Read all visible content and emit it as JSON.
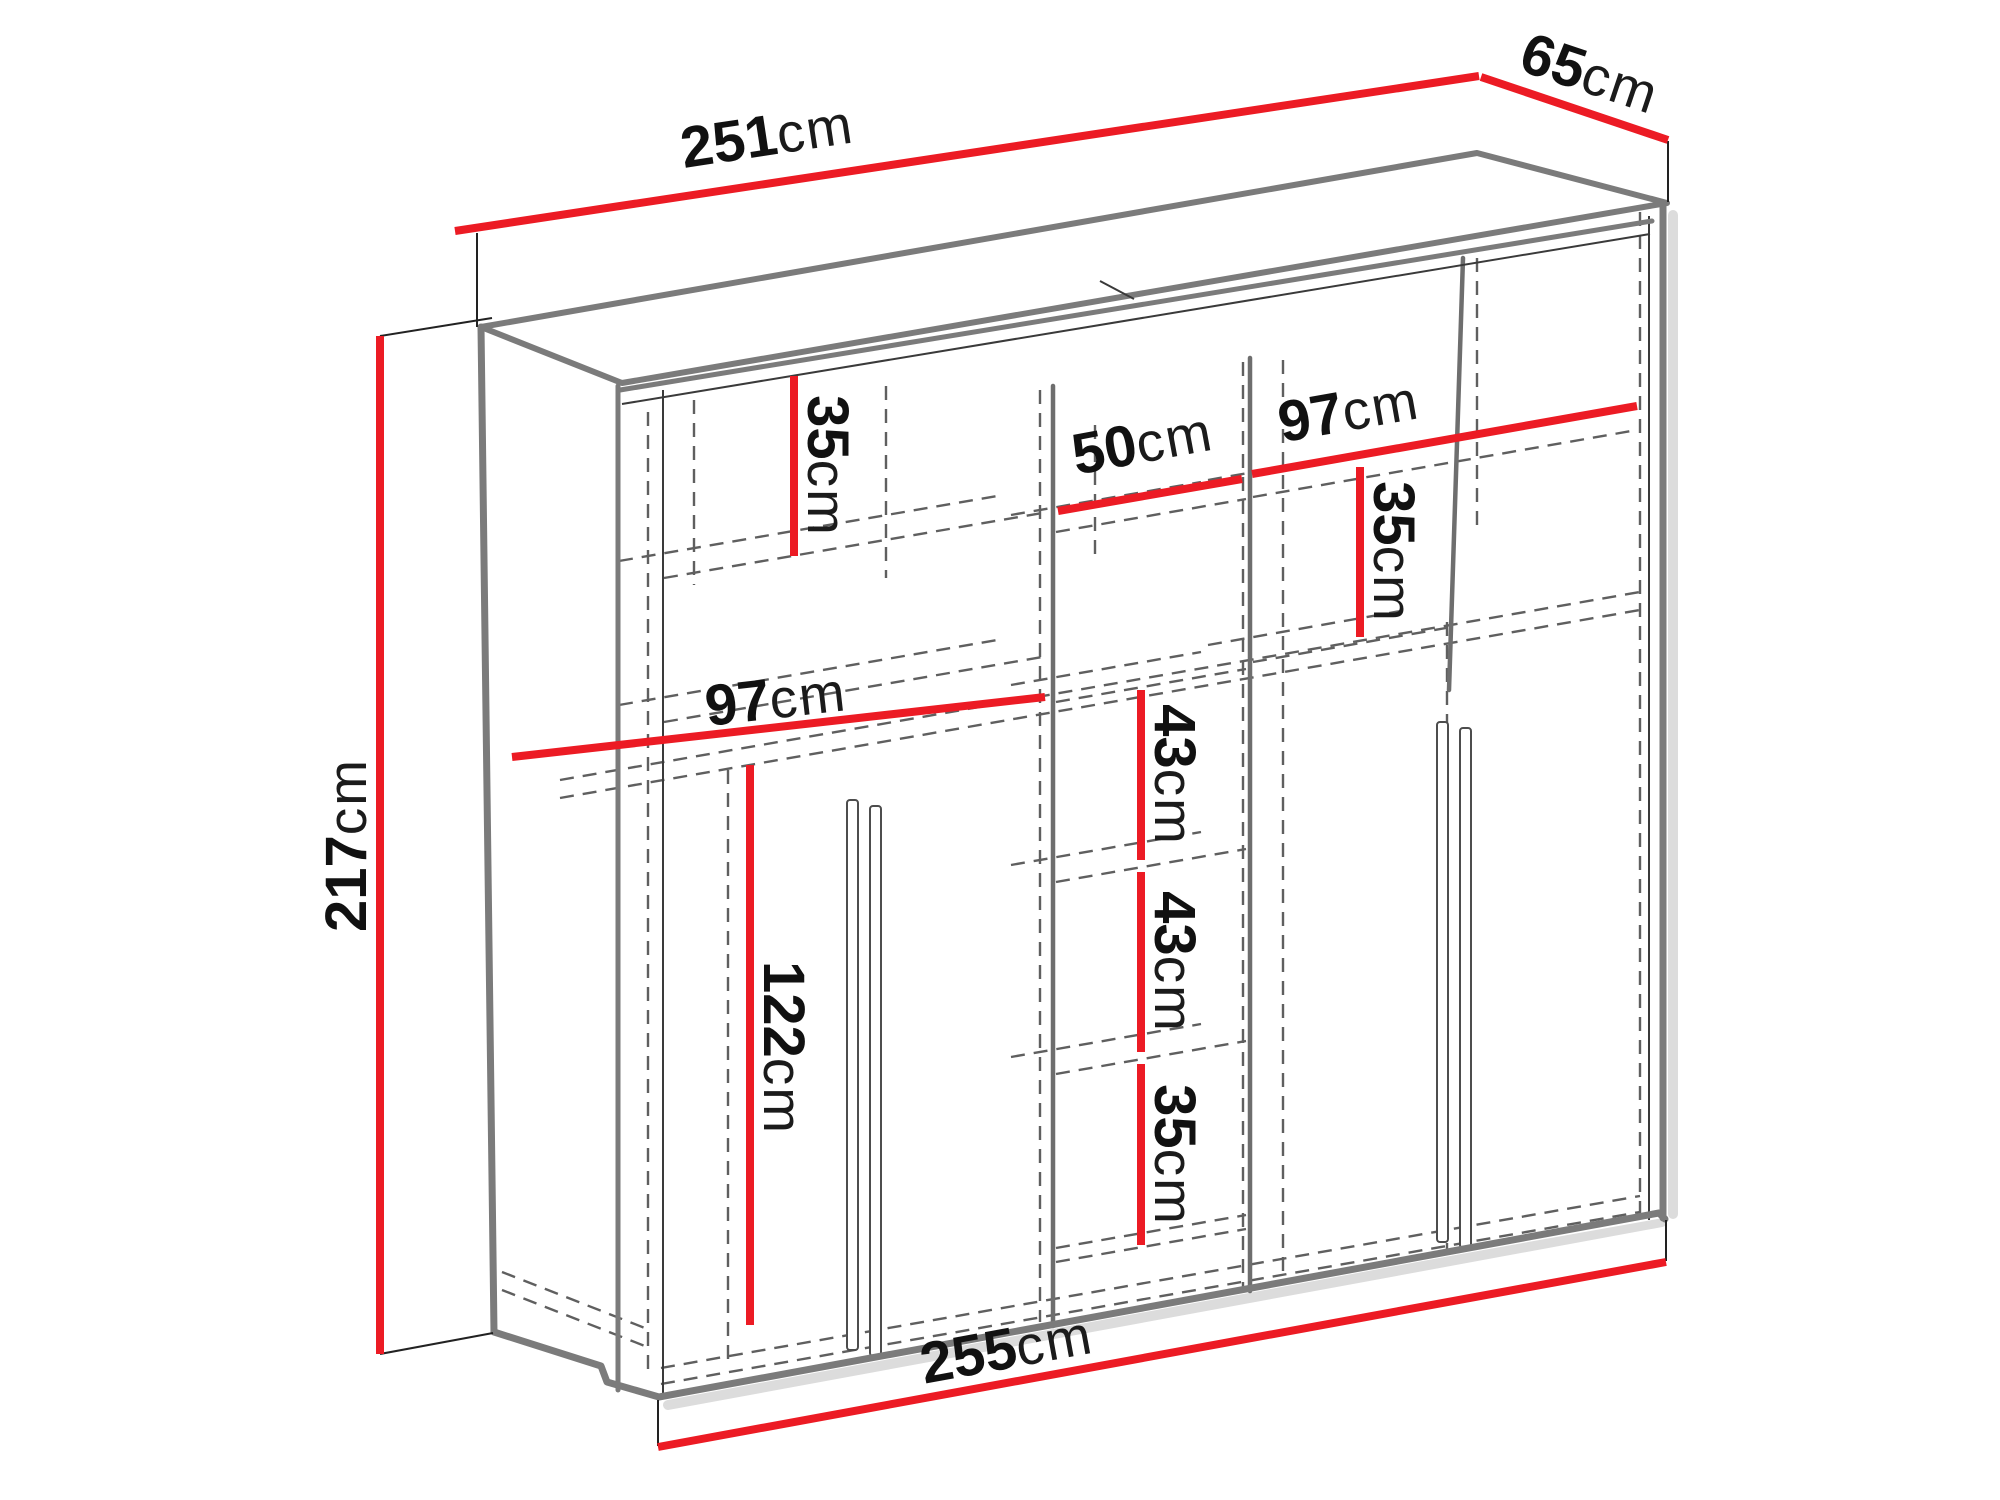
{
  "diagram": {
    "type": "furniture-dimension-drawing",
    "subject": "three-door sliding wardrobe with shelves and hanging rails",
    "unit": "cm",
    "colors": {
      "dimension_red": "#ec1b24",
      "frame_gray": "#7b7b7b",
      "hidden_line_gray": "#5f5f5f",
      "label_black": "#111111"
    },
    "dimensions": {
      "total_width_top": {
        "value": "251",
        "unit": "cm"
      },
      "depth": {
        "value": "65",
        "unit": "cm"
      },
      "total_height": {
        "value": "217",
        "unit": "cm"
      },
      "total_width_bottom": {
        "value": "255",
        "unit": "cm"
      },
      "left_top_shelf_height": {
        "value": "35",
        "unit": "cm"
      },
      "middle_section_width": {
        "value": "50",
        "unit": "cm"
      },
      "right_section_width": {
        "value": "97",
        "unit": "cm"
      },
      "right_top_shelf_height": {
        "value": "35",
        "unit": "cm"
      },
      "left_section_width": {
        "value": "97",
        "unit": "cm"
      },
      "left_hanging_height": {
        "value": "122",
        "unit": "cm"
      },
      "middle_shelf_gap_1": {
        "value": "43",
        "unit": "cm"
      },
      "middle_shelf_gap_2": {
        "value": "43",
        "unit": "cm"
      },
      "middle_bottom_gap": {
        "value": "35",
        "unit": "cm"
      }
    }
  }
}
